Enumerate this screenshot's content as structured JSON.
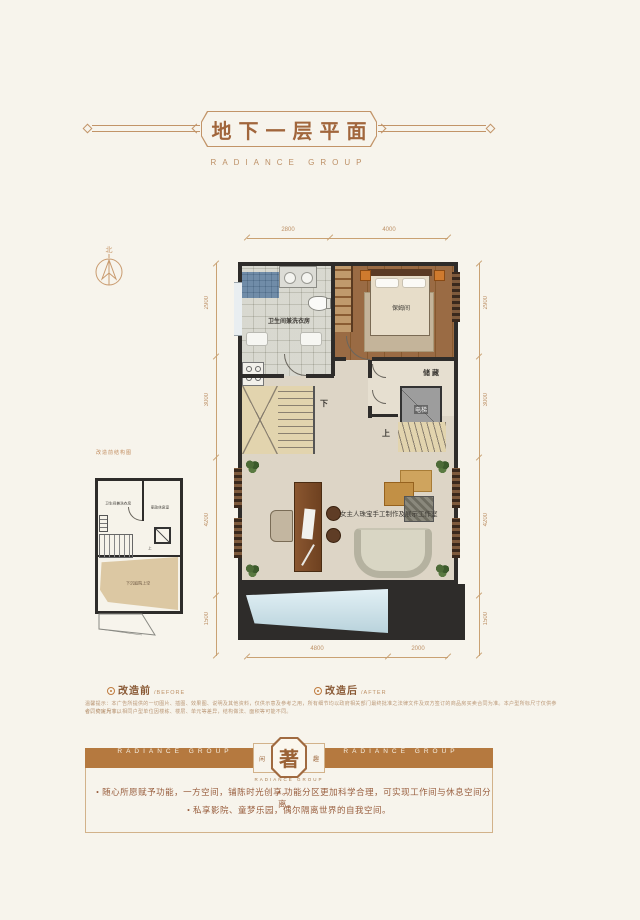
{
  "header": {
    "title": "地下一层平面",
    "subtitle": "RADIANCE GROUP"
  },
  "compass": {
    "north": "北"
  },
  "plan": {
    "dims": {
      "top": [
        "2800",
        "4000"
      ],
      "bottom": [
        "4800",
        "2000"
      ],
      "left": [
        "2900",
        "3000",
        "4200",
        "1500"
      ],
      "right": [
        "2900",
        "3000",
        "4200",
        "1500"
      ]
    },
    "rooms": {
      "bath": "卫生间兼洗衣房",
      "nanny": "保姆间",
      "storage": "储藏",
      "elevator": "电梯",
      "stair_down": "下",
      "stair_up": "上",
      "studio": "女主人珠宝手工制作及展示工作室"
    }
  },
  "inset": {
    "caption": "改造前结构图",
    "bath": "卫生间兼洗衣房",
    "rest": "家政休息室",
    "void": "下沉庭院上空",
    "stair_up": "上"
  },
  "compare": {
    "before": "改造前",
    "before_en": "/BEFORE",
    "after": "改造后",
    "after_en": "/AFTER"
  },
  "disclaimer": {
    "line1": "温馨提示：本广告所提供的一切图片、插图、效果图、说明及其他资料，仅供示意及参考之用，所有细节均以政府相关部门最终批准之法律文件及双方签订的商品房买卖合同为准。本户型所标尺寸仅供参考，交房尺寸以",
    "line2": "合同约定为准。相同户型单位因楼栋、楼层、单元等差异，结构做法、面积等可能不同。"
  },
  "banner": {
    "left": "RADIANCE GROUP",
    "right": "RADIANCE GROUP",
    "seal": "著",
    "seal_left": "闲",
    "seal_right": "趣",
    "sub": "RADIANCE GROUP"
  },
  "bullets": {
    "b1": "随心所愿赋予功能，一方空间，铺陈时光创享。",
    "b2": "功能分区更加科学合理，可实现工作间与休息空间分离。",
    "b3": "私享影院、童梦乐园，偶尔隔离世界的自我空间。"
  }
}
